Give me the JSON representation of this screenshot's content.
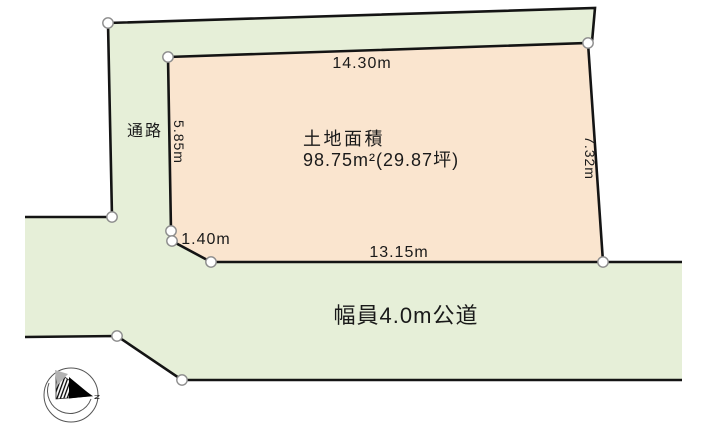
{
  "plot": {
    "area_title": "土地面積",
    "area_value": "98.75m²(29.87坪)",
    "dim_top": "14.30m",
    "dim_left": "5.85m",
    "dim_right": "7.32m",
    "dim_bottom": "13.15m",
    "dim_notch": "1.40m"
  },
  "passage": {
    "label": "通路"
  },
  "road": {
    "label": "幅員4.0m公道"
  },
  "compass": {
    "north": "N"
  },
  "colors": {
    "land_fill": "#fae5cf",
    "road_fill": "#e6efd8",
    "outline": "#141414",
    "marker_fill": "#ffffff",
    "marker_stroke": "#8c8c8c"
  }
}
